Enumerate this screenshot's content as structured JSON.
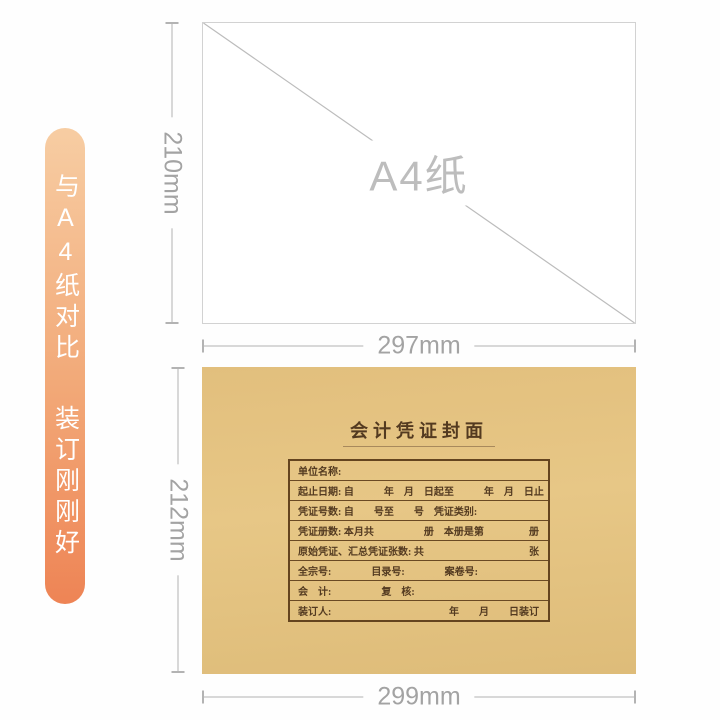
{
  "banner": {
    "line1": "与A4纸对比",
    "line2": "装订刚刚好"
  },
  "a4": {
    "label": "A4纸",
    "width_label": "297mm",
    "height_label": "210mm"
  },
  "cover": {
    "title": "会计凭证封面",
    "width_label": "299mm",
    "height_label": "212mm",
    "form_rows": [
      {
        "left": "单位名称:",
        "right": ""
      },
      {
        "left": "起止日期: 自　　　年　月　日起至　　　年　月　日止",
        "right": ""
      },
      {
        "left": "凭证号数: 自　　号至　　号　凭证类别:",
        "right": ""
      },
      {
        "left": "凭证册数: 本月共　　　　　册　本册是第",
        "right": "册"
      },
      {
        "left": "原始凭证、汇总凭证张数: 共",
        "right": "张"
      },
      {
        "left": "全宗号:　　　　目录号:　　　　案卷号:",
        "right": ""
      },
      {
        "left": "会　计:　　　　　复　核:",
        "right": ""
      },
      {
        "left": "装订人:",
        "right": "年　　月　　日装订"
      }
    ]
  },
  "colors": {
    "banner_gradient_top": "#f7cda3",
    "banner_gradient_bottom": "#ee8455",
    "kraft_paper": "#e7c786",
    "form_ink_brown": "#533a20",
    "dimension_gray": "#a3a3a3",
    "page_background": "#fefefe"
  }
}
